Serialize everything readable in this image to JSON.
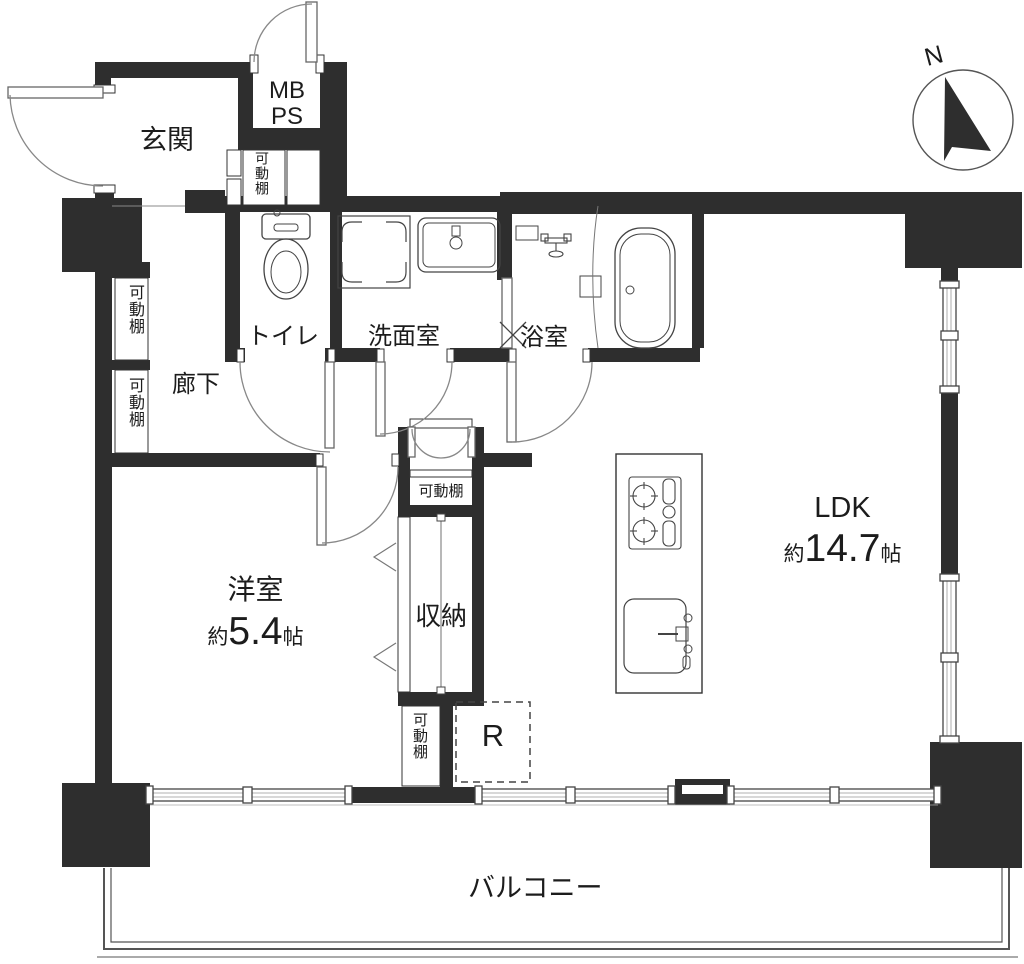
{
  "compass": {
    "north": "N"
  },
  "labels": {
    "genkan": "玄関",
    "mb": "MB",
    "ps": "PS",
    "movable_shelf": "可動棚",
    "toilet": "トイレ",
    "washroom": "洗面室",
    "bathroom": "浴室",
    "hallway": "廊下",
    "storage": "収納",
    "balcony": "バルコニー",
    "refrigerator": "R"
  },
  "rooms": {
    "western": {
      "name": "洋室",
      "size_prefix": "約",
      "size_value": "5.4",
      "size_unit": "帖"
    },
    "ldk": {
      "name": "LDK",
      "size_prefix": "約",
      "size_value": "14.7",
      "size_unit": "帖"
    }
  },
  "colors": {
    "wall": "#2e2e2e",
    "line": "#555555",
    "text": "#1c1c1c"
  }
}
